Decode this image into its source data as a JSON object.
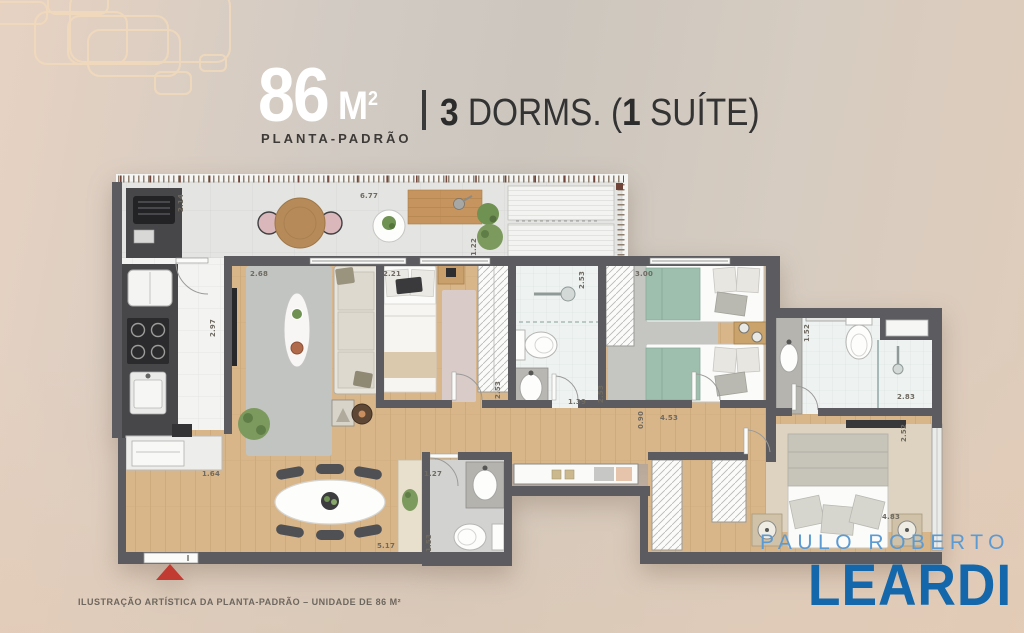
{
  "header": {
    "area_value": "86",
    "area_unit": "M",
    "area_sup": "2",
    "subtitle": "PLANTA-PADRÃO",
    "dorm_count": "3",
    "dorm_label": " DORMS. (",
    "suite_count": "1",
    "suite_label": " SUÍTE)"
  },
  "plan": {
    "dimensions": {
      "terrace_depth": "2.14",
      "terrace_width": "6.77",
      "terrace_side": "1.22",
      "living_width": "2.68",
      "kitchen_depth": "2.97",
      "kitchen_pass": "1.64",
      "bedroom1_width": "2.21",
      "bath1_shower_depth": "2.53",
      "bedroom2_width": "3.00",
      "suite_bath_depth": "1.52",
      "bath1_depth": "2.53",
      "bath1_width": "1.39",
      "bedroom2_depth": "2.53",
      "suite_bath_width": "2.83",
      "hall_depth": "0.90",
      "hall_width": "4.53",
      "lavabo_width": "1.27",
      "lavabo_depth": "1.53",
      "dining_width": "5.17",
      "suite_depth": "2.52",
      "suite_width": "4.83"
    }
  },
  "footer": {
    "caption": "ILUSTRAÇÃO ARTÍSTICA DA PLANTA-PADRÃO – UNIDADE DE 86 M²"
  },
  "logo": {
    "line1": "PAULO ROBERTO",
    "line2": "LEARDI"
  },
  "colors": {
    "wall": "#5c5c60",
    "wood_floor": "#d8b68a",
    "entrance_arrow_red": "#c23b32",
    "logo_light_blue": "#5b9ad2",
    "logo_dark_blue": "#1467aa",
    "background_left": "#e7d2c2",
    "background_mid": "#ccc6be",
    "background_right": "#e0ccba",
    "decor_outline": "#f2dabc"
  }
}
